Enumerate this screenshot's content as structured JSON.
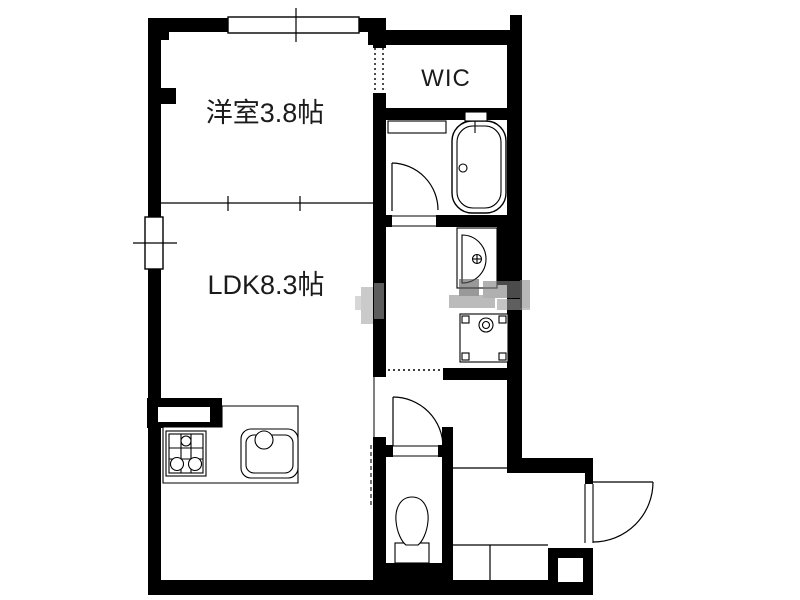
{
  "floorplan": {
    "rooms": {
      "western_room": {
        "label": "洋室3.8帖"
      },
      "ldk": {
        "label": "LDK8.3帖"
      },
      "wic": {
        "label": "WIC"
      }
    },
    "fixtures": [
      "bathtub",
      "washbasin",
      "washing-machine-pan",
      "toilet",
      "gas-stove",
      "kitchen-sink",
      "kitchen-counter",
      "entrance-pillar"
    ],
    "colors": {
      "wall": "#000000",
      "background": "#ffffff",
      "label_text": "#1b1b1b",
      "watermark_gray": "#8f8f8f"
    }
  }
}
